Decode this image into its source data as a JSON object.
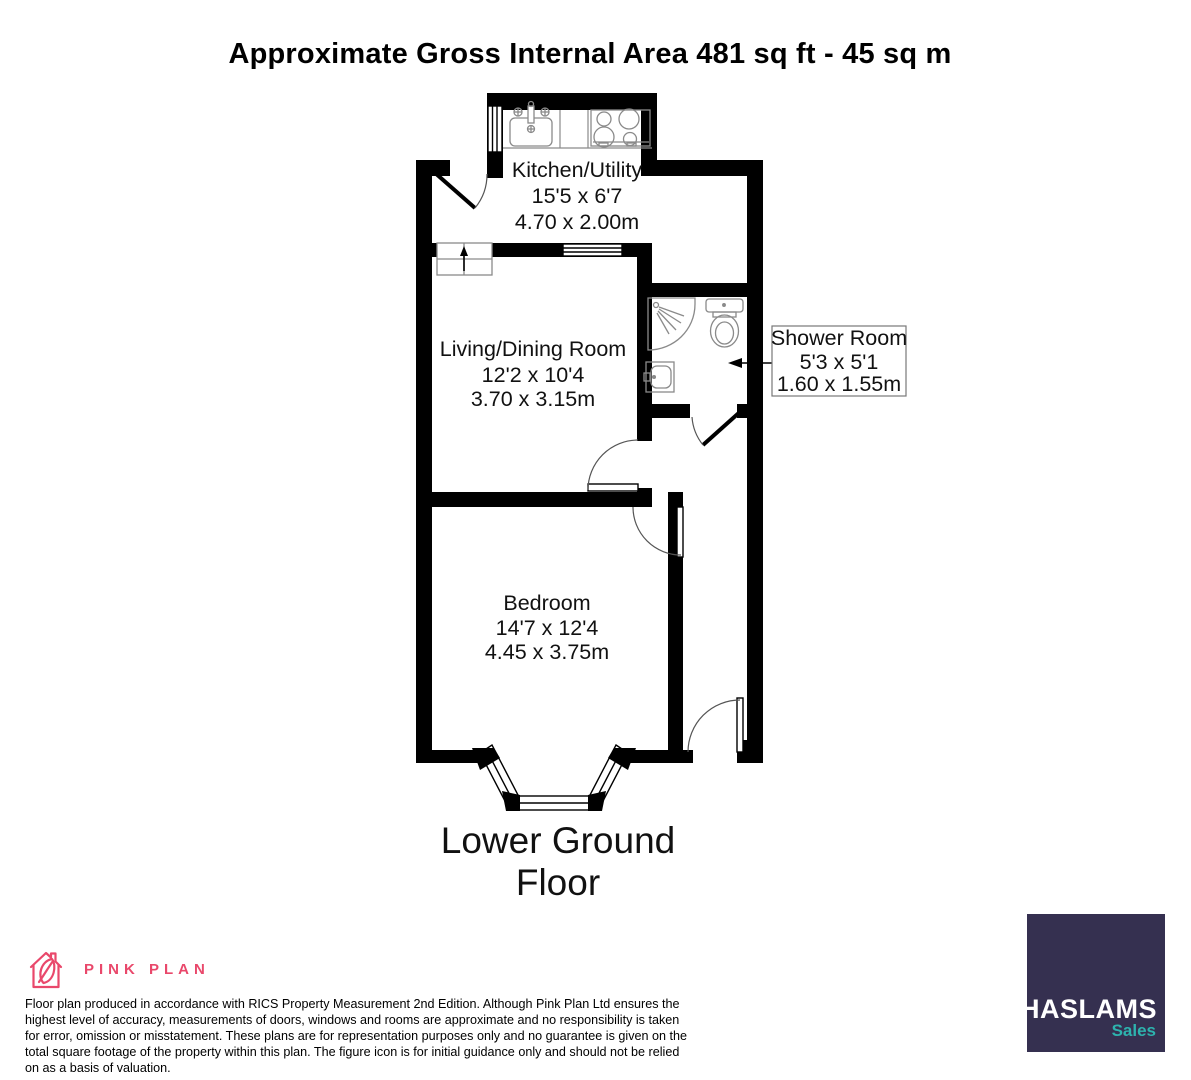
{
  "title": "Approximate Gross Internal Area 481 sq ft - 45 sq m",
  "floor_label": "Lower Ground Floor",
  "rooms": {
    "kitchen": {
      "name": "Kitchen/Utility",
      "imperial": "15'5 x 6'7",
      "metric": "4.70 x 2.00m"
    },
    "living": {
      "name": "Living/Dining Room",
      "imperial": "12'2 x 10'4",
      "metric": "3.70 x 3.15m"
    },
    "shower": {
      "name": "Shower Room",
      "imperial": "5'3 x 5'1",
      "metric": "1.60 x 1.55m"
    },
    "bedroom": {
      "name": "Bedroom",
      "imperial": "14'7 x 12'4",
      "metric": "4.45 x 3.75m"
    }
  },
  "branding": {
    "producer": {
      "name": "PINK PLAN",
      "color": "#e9486b"
    },
    "agent": {
      "name": "HASLAMS",
      "tagline": "Sales",
      "bg_color": "#353050",
      "name_color": "#ffffff",
      "tagline_color": "#2db3ae"
    }
  },
  "disclaimer": "Floor plan produced in accordance with RICS Property Measurement 2nd Edition. Although Pink Plan Ltd ensures the highest level of accuracy, measurements of doors, windows and rooms are approximate and no responsibility is taken for error, omission or misstatement. These plans are for representation purposes only and no guarantee is given on the total square footage of the property within this plan. The figure icon is for initial guidance only and should not be relied on as a basis of valuation.",
  "colors": {
    "wall": "#000000",
    "fixture": "#8a8a8a",
    "door_arc": "#555555"
  }
}
